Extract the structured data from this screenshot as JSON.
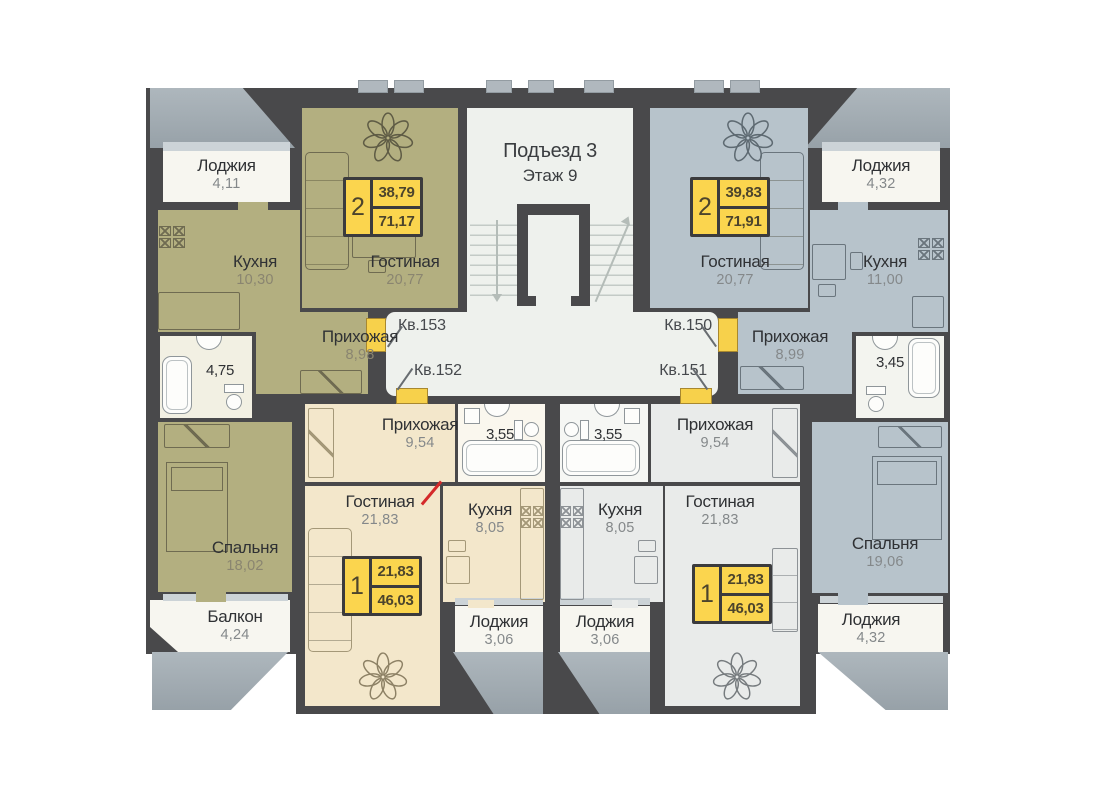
{
  "palette": {
    "wall": "#49494b",
    "olive": "#b3af80",
    "cream": "#f3e7cb",
    "gray_apt": "#e9ebea",
    "blue": "#b7c3cb",
    "corridor": "#eef1ed",
    "accent_yellow": "#f7d14b",
    "badge_yellow": "#fbd54e"
  },
  "header": {
    "entrance": "Подъезд 3",
    "floor": "Этаж 9"
  },
  "corridor_labels": {
    "kv153": "Кв.153",
    "kv152": "Кв.152",
    "kv150": "Кв.150",
    "kv151": "Кв.151"
  },
  "badges": {
    "kv153": {
      "rooms": "2",
      "living": "38,79",
      "total": "71,17"
    },
    "kv150": {
      "rooms": "2",
      "living": "39,83",
      "total": "71,91"
    },
    "kv152": {
      "rooms": "1",
      "living": "21,83",
      "total": "46,03"
    },
    "kv151": {
      "rooms": "1",
      "living": "21,83",
      "total": "46,03"
    }
  },
  "rooms": {
    "loggia_tl": {
      "name": "Лоджия",
      "area": "4,11"
    },
    "kv153_kitchen": {
      "name": "Кухня",
      "area": "10,30"
    },
    "kv153_living": {
      "name": "Гостиная",
      "area": "20,77"
    },
    "kv153_hall": {
      "name": "Прихожая",
      "area": "8,98"
    },
    "kv153_bath": {
      "area": "4,75"
    },
    "kv153_bedroom": {
      "name": "Спальня",
      "area": "18,02"
    },
    "balcony_bl": {
      "name": "Балкон",
      "area": "4,24"
    },
    "kv150_living": {
      "name": "Гостиная",
      "area": "20,77"
    },
    "kv150_kitchen": {
      "name": "Кухня",
      "area": "11,00"
    },
    "kv150_hall": {
      "name": "Прихожая",
      "area": "8,99"
    },
    "kv150_bath": {
      "area": "3,45"
    },
    "kv150_bedroom": {
      "name": "Спальня",
      "area": "19,06"
    },
    "loggia_tr": {
      "name": "Лоджия",
      "area": "4,32"
    },
    "loggia_br": {
      "name": "Лоджия",
      "area": "4,32"
    },
    "kv152_hall": {
      "name": "Прихожая",
      "area": "9,54"
    },
    "kv152_bath": {
      "area": "3,55"
    },
    "kv152_living": {
      "name": "Гостиная",
      "area": "21,83"
    },
    "kv152_kitchen": {
      "name": "Кухня",
      "area": "8,05"
    },
    "kv152_loggia": {
      "name": "Лоджия",
      "area": "3,06"
    },
    "kv151_bath": {
      "area": "3,55"
    },
    "kv151_hall": {
      "name": "Прихожая",
      "area": "9,54"
    },
    "kv151_kitchen": {
      "name": "Кухня",
      "area": "8,05"
    },
    "kv151_living": {
      "name": "Гостиная",
      "area": "21,83"
    },
    "kv151_loggia": {
      "name": "Лоджия",
      "area": "3,06"
    }
  }
}
